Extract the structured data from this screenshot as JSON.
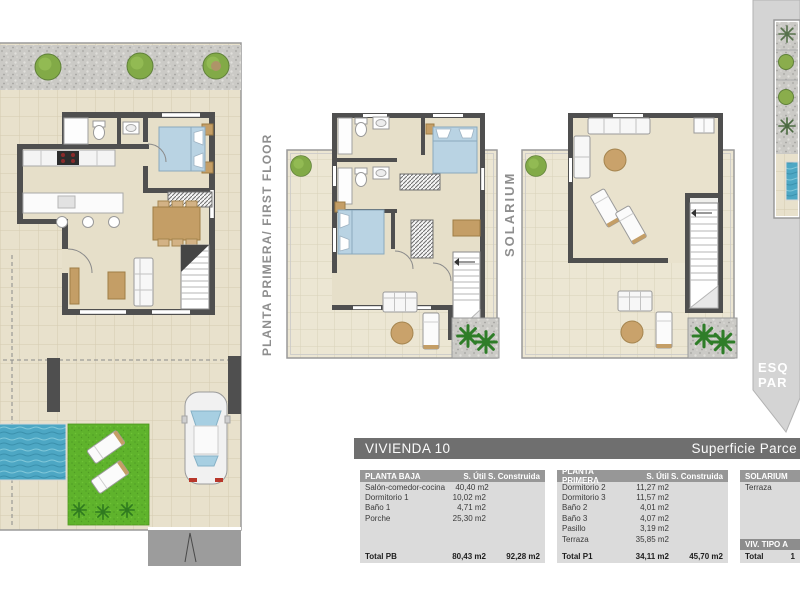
{
  "header": {
    "project_title": "VIVIENDA 10",
    "parcel_title": "Superficie Parce"
  },
  "plan_labels": {
    "first_floor": "PLANTA PRIMERA/ FIRST FLOOR",
    "solarium": "SOLARIUM"
  },
  "side_panel": {
    "line1": "ESQ",
    "line2": "PAR"
  },
  "tables": {
    "planta_baja": {
      "title": "PLANTA BAJA",
      "col_util": "S. Útil",
      "col_construida": "S. Construida",
      "rows": [
        {
          "label": "Salón-comedor-cocina",
          "util": "40,40 m2"
        },
        {
          "label": "Dormitorio 1",
          "util": "10,02 m2"
        },
        {
          "label": "Baño 1",
          "util": "4,71 m2"
        },
        {
          "label": "Porche",
          "util": "25,30 m2"
        }
      ],
      "total": {
        "label": "Total PB",
        "util": "80,43 m2",
        "construida": "92,28 m2"
      }
    },
    "planta_primera": {
      "title": "PLANTA PRIMERA",
      "col_util": "S. Útil",
      "col_construida": "S. Construida",
      "rows": [
        {
          "label": "Dormitorio 2",
          "util": "11,27 m2"
        },
        {
          "label": "Dormitorio 3",
          "util": "11,57 m2"
        },
        {
          "label": "Baño 2",
          "util": "4,01 m2"
        },
        {
          "label": "Baño 3",
          "util": "4,07 m2"
        },
        {
          "label": "Pasillo",
          "util": "3,19 m2"
        },
        {
          "label": "Terraza",
          "util": "35,85 m2"
        }
      ],
      "total": {
        "label": "Total P1",
        "util": "34,11 m2",
        "construida": "45,70 m2"
      }
    },
    "solarium": {
      "title": "SOLARIUM",
      "rows": [
        {
          "label": "Terraza",
          "util": ""
        }
      ],
      "sub_header": "VIV. TIPO A",
      "total": {
        "label": "Total",
        "util": "1"
      }
    }
  },
  "colors": {
    "wall": "#4f4f4f",
    "tile_floor": "#e8e1cc",
    "pool_water": "#4da7c4",
    "grass": "#5fb32c",
    "bed": "#b9d3e3",
    "wood": "#c49e66",
    "title_bar": "#6f6f6f",
    "table_header": "#979797",
    "table_body": "#dbdbdb",
    "side_panel": "#d4d4d4"
  }
}
